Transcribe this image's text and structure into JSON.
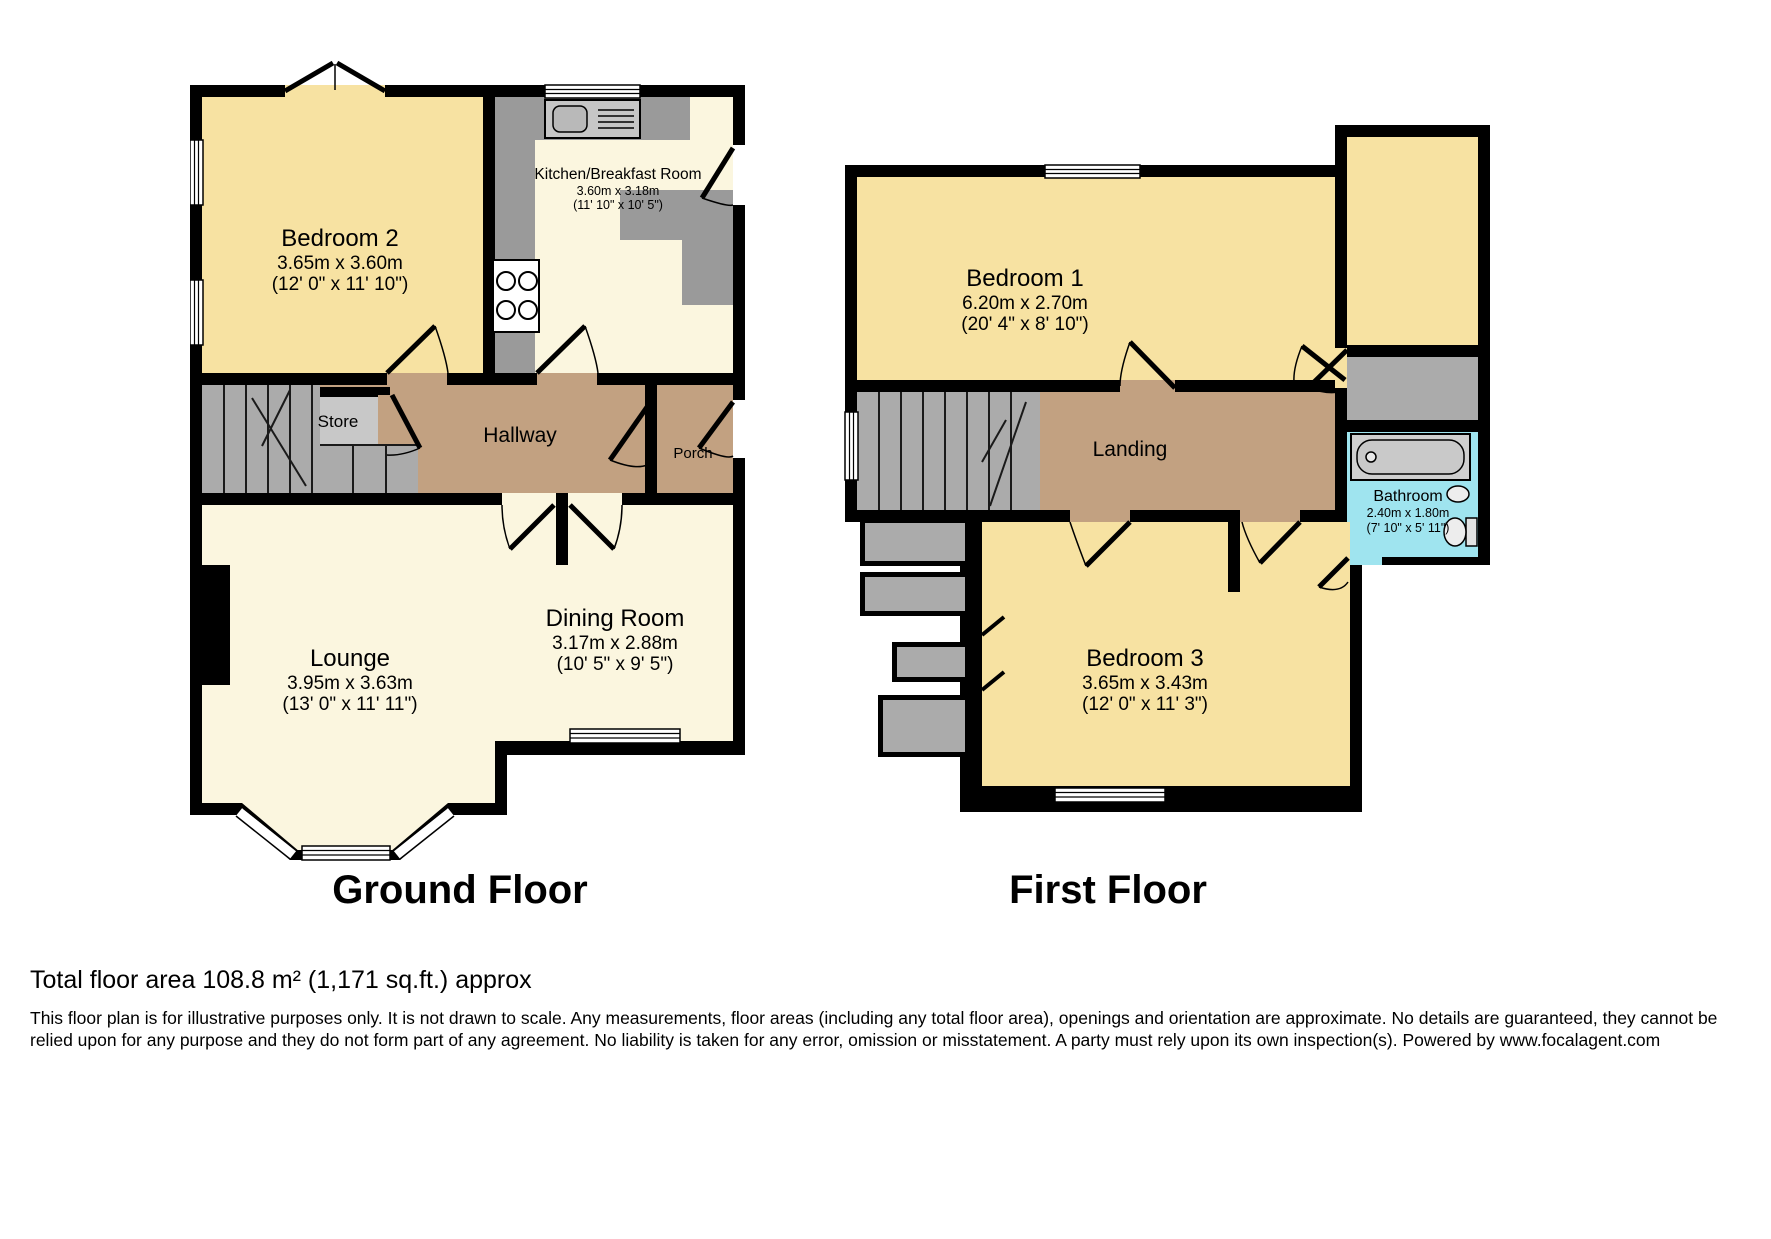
{
  "floors": {
    "ground": {
      "label": "Ground Floor",
      "rooms": {
        "bedroom2": {
          "name": "Bedroom 2",
          "dims_m": "3.65m x 3.60m",
          "dims_ft": "(12' 0\" x 11' 10\")"
        },
        "kitchen": {
          "name": "Kitchen/Breakfast Room",
          "dims_m": "3.60m x 3.18m",
          "dims_ft": "(11' 10\" x 10' 5\")"
        },
        "hallway": {
          "name": "Hallway"
        },
        "store": {
          "name": "Store"
        },
        "porch": {
          "name": "Porch"
        },
        "lounge": {
          "name": "Lounge",
          "dims_m": "3.95m x 3.63m",
          "dims_ft": "(13' 0\" x 11' 11\")"
        },
        "dining": {
          "name": "Dining Room",
          "dims_m": "3.17m x 2.88m",
          "dims_ft": "(10' 5\" x 9' 5\")"
        }
      }
    },
    "first": {
      "label": "First Floor",
      "rooms": {
        "bedroom1": {
          "name": "Bedroom 1",
          "dims_m": "6.20m x 2.70m",
          "dims_ft": "(20' 4\" x 8' 10\")"
        },
        "landing": {
          "name": "Landing"
        },
        "bathroom": {
          "name": "Bathroom",
          "dims_m": "2.40m x 1.80m",
          "dims_ft": "(7' 10\" x 5' 11\")"
        },
        "bedroom3": {
          "name": "Bedroom 3",
          "dims_m": "3.65m x 3.43m",
          "dims_ft": "(12' 0\" x 11' 3\")"
        }
      }
    }
  },
  "footer": {
    "total_area": "Total floor area 108.8 m² (1,171 sq.ft.) approx",
    "disclaimer": "This floor plan is for illustrative purposes only. It is not drawn to scale. Any measurements, floor areas (including any total floor area), openings and orientation are approximate. No details are guaranteed, they cannot be relied upon for any purpose and they do not form part of any agreement. No liability is taken for any error, omission or misstatement. A party must rely upon its own inspection(s). Powered by www.focalagent.com"
  },
  "colors": {
    "wall": "#000000",
    "bedroom_fill": "#F7E2A2",
    "living_fill": "#FBF6DF",
    "hall_fill": "#C2A181",
    "bathroom_fill": "#9FE4EF",
    "stairs_fill": "#ABABAB",
    "counter_fill": "#9A9A9A",
    "store_fill": "#C8C8C8"
  }
}
